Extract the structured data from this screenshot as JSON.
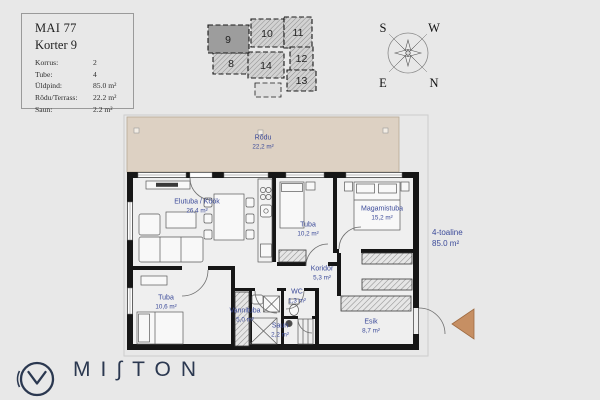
{
  "header": {
    "title": "MAI 77",
    "subtitle": "Korter 9",
    "rows": [
      {
        "label": "Korrus:",
        "value": "2"
      },
      {
        "label": "Tube:",
        "value": "4"
      },
      {
        "label": "Üldpind:",
        "value": "85.0 m²"
      },
      {
        "label": "Rõdu/Terrass:",
        "value": "22.2 m²"
      },
      {
        "label": "Saun:",
        "value": "2.2 m²"
      }
    ]
  },
  "minimap": {
    "units": [
      {
        "number": "9",
        "highlighted": true
      },
      {
        "number": "10",
        "highlighted": false
      },
      {
        "number": "11",
        "highlighted": false
      },
      {
        "number": "8",
        "highlighted": false
      },
      {
        "number": "14",
        "highlighted": false
      },
      {
        "number": "12",
        "highlighted": false
      },
      {
        "number": "13",
        "highlighted": false
      }
    ],
    "highlight_color": "#9d9d9d"
  },
  "compass": {
    "s": "S",
    "w": "W",
    "e": "E",
    "n": "N"
  },
  "plan": {
    "balcony": {
      "name": "Rõdu",
      "area": "22,2 m²"
    },
    "rooms": [
      {
        "name": "Elutuba / Köök",
        "area": "26,4 m²"
      },
      {
        "name": "Tuba",
        "area": "10,2 m²"
      },
      {
        "name": "Magamistuba",
        "area": "15,2 m²"
      },
      {
        "name": "Koridor",
        "area": "5,3 m²"
      },
      {
        "name": "Tuba",
        "area": "10,6 m²"
      },
      {
        "name": "Vannituba",
        "area": "5,0 m²"
      },
      {
        "name": "WC",
        "area": "1,3 m²"
      },
      {
        "name": "Saun",
        "area": "2,2 m²"
      },
      {
        "name": "Esik",
        "area": "8,7 m²"
      }
    ],
    "summary": {
      "type": "4-toaline",
      "area": "85.0 m²"
    },
    "label_color": "#3b4a99",
    "balcony_color": "#ddd1c3",
    "entrance_arrow_color": "#c68f63"
  },
  "logo": {
    "brand": "MI∫TON"
  }
}
